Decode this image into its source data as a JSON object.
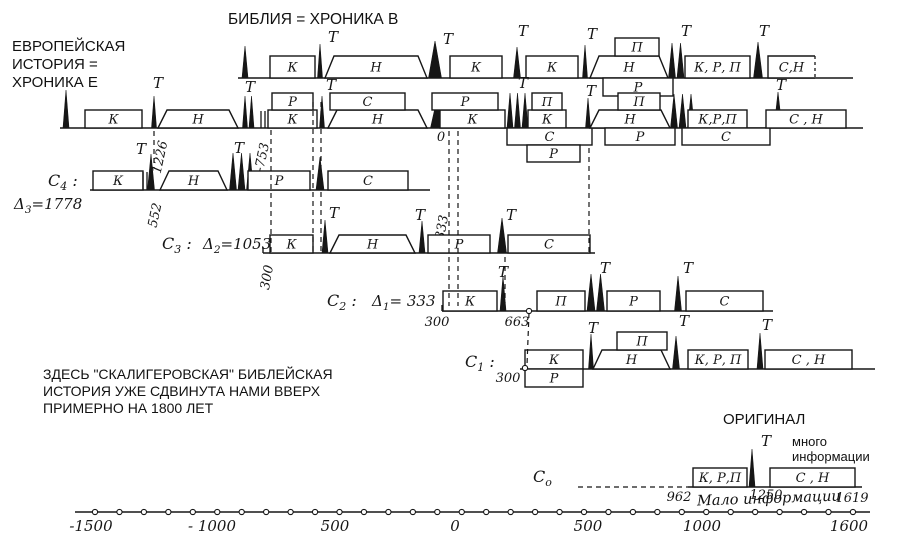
{
  "ink": "#161616",
  "bg": "#ffffff",
  "titles": {
    "bible": "БИБЛИЯ = ХРОНИКА В",
    "europe_lines": [
      "ЕВРОПЕЙСКАЯ",
      "ИСТОРИЯ =",
      "ХРОНИКА Е"
    ],
    "note_lines": [
      "ЗДЕСЬ \"СКАЛИГЕРОВСКАЯ\" БИБЛЕЙСКАЯ",
      "ИСТОРИЯ УЖЕ СДВИНУТА НАМИ ВВЕРХ",
      "ПРИМЕРНО НА 1800 ЛЕТ"
    ],
    "original": "ОРИГИНАЛ",
    "much_info_lines": [
      "много",
      "информации"
    ],
    "little_info": "Мало информации"
  },
  "rows": [
    {
      "id": "B",
      "baseline": {
        "x1": 238,
        "x2": 853,
        "y": 78
      },
      "bh": 22,
      "sh": 18,
      "els": [
        {
          "t": "s",
          "x": 245,
          "h": 32,
          "w": 6
        },
        {
          "t": "b",
          "x": 270,
          "w": 45,
          "l": "К"
        },
        {
          "t": "s",
          "x": 320,
          "h": 34,
          "w": 5
        },
        {
          "t": "T",
          "x": 333,
          "y": 42
        },
        {
          "t": "tr",
          "x": 325,
          "w": 102,
          "l": "Н"
        },
        {
          "t": "s",
          "x": 435,
          "h": 37,
          "w": 13
        },
        {
          "t": "T",
          "x": 448,
          "y": 44
        },
        {
          "t": "b",
          "x": 450,
          "w": 52,
          "l": "К"
        },
        {
          "t": "s",
          "x": 517,
          "h": 31,
          "w": 7
        },
        {
          "t": "T",
          "x": 523,
          "y": 36
        },
        {
          "t": "b",
          "x": 526,
          "w": 52,
          "l": "К"
        },
        {
          "t": "s",
          "x": 585,
          "h": 33,
          "w": 5
        },
        {
          "t": "T",
          "x": 592,
          "y": 39
        },
        {
          "t": "tr",
          "x": 590,
          "w": 78,
          "l": "Н"
        },
        {
          "t": "b",
          "x": 615,
          "w": 44,
          "l": "П",
          "lane": -1
        },
        {
          "t": "b",
          "x": 603,
          "w": 70,
          "l": "Р",
          "lane": 1
        },
        {
          "t": "s",
          "x": 672,
          "h": 35,
          "w": 7,
          "n": 2
        },
        {
          "t": "T",
          "x": 686,
          "y": 36
        },
        {
          "t": "b",
          "x": 685,
          "w": 65,
          "l": "К, Р, П"
        },
        {
          "t": "s",
          "x": 758,
          "h": 36,
          "w": 9
        },
        {
          "t": "T",
          "x": 764,
          "y": 36
        },
        {
          "t": "b",
          "x": 768,
          "w": 47,
          "l": "С,Н",
          "dr": true
        }
      ]
    },
    {
      "id": "E",
      "baseline": {
        "x1": 60,
        "x2": 863,
        "y": 128
      },
      "bh": 18,
      "sh": 17,
      "els": [
        {
          "t": "s",
          "x": 66,
          "h": 38,
          "w": 6
        },
        {
          "t": "b",
          "x": 85,
          "w": 57,
          "l": "К"
        },
        {
          "t": "T",
          "x": 158,
          "y": 88
        },
        {
          "t": "s",
          "x": 154,
          "h": 32,
          "w": 5
        },
        {
          "t": "tr",
          "x": 158,
          "w": 80,
          "l": "Н"
        },
        {
          "t": "s",
          "x": 245,
          "h": 32,
          "w": 5,
          "n": 2
        },
        {
          "t": "T",
          "x": 250,
          "y": 92
        },
        {
          "t": "d",
          "x": 261
        },
        {
          "t": "b",
          "x": 268,
          "w": 49,
          "l": "К"
        },
        {
          "t": "b",
          "x": 272,
          "w": 41,
          "l": "Р",
          "lane": -1
        },
        {
          "t": "s",
          "x": 322,
          "h": 32,
          "w": 5
        },
        {
          "t": "T",
          "x": 331,
          "y": 90
        },
        {
          "t": "tr",
          "x": 328,
          "w": 99,
          "l": "Н"
        },
        {
          "t": "b",
          "x": 330,
          "w": 75,
          "l": "С",
          "lane": -1
        },
        {
          "t": "s",
          "x": 437,
          "h": 29,
          "w": 13
        },
        {
          "t": "b",
          "x": 440,
          "w": 65,
          "l": "К"
        },
        {
          "t": "b",
          "x": 432,
          "w": 66,
          "l": "Р",
          "lane": -1
        },
        {
          "t": "s",
          "x": 510,
          "h": 35,
          "w": 6,
          "n": 3
        },
        {
          "t": "T",
          "x": 523,
          "y": 88
        },
        {
          "t": "b",
          "x": 528,
          "w": 38,
          "l": "К"
        },
        {
          "t": "b",
          "x": 532,
          "w": 30,
          "l": "П",
          "lane": -1
        },
        {
          "t": "b",
          "x": 507,
          "w": 85,
          "l": "С",
          "lane": 1
        },
        {
          "t": "b",
          "x": 527,
          "w": 53,
          "l": "Р",
          "lane": 2
        },
        {
          "t": "s",
          "x": 588,
          "h": 30,
          "w": 5
        },
        {
          "t": "T",
          "x": 591,
          "y": 96
        },
        {
          "t": "tr",
          "x": 590,
          "w": 80,
          "l": "Н"
        },
        {
          "t": "b",
          "x": 618,
          "w": 42,
          "l": "П",
          "lane": -1
        },
        {
          "t": "b",
          "x": 605,
          "w": 70,
          "l": "Р",
          "lane": 1
        },
        {
          "t": "s",
          "x": 674,
          "h": 34,
          "w": 7,
          "n": 3
        },
        {
          "t": "b",
          "x": 688,
          "w": 59,
          "l": "К,Р,П"
        },
        {
          "t": "b",
          "x": 682,
          "w": 88,
          "l": "С",
          "lane": 1
        },
        {
          "t": "s",
          "x": 778,
          "h": 36,
          "w": 8
        },
        {
          "t": "T",
          "x": 781,
          "y": 90
        },
        {
          "t": "b",
          "x": 766,
          "w": 80,
          "l": "С , Н"
        }
      ]
    },
    {
      "id": "C4",
      "baseline": {
        "x1": 90,
        "x2": 430,
        "y": 190
      },
      "bh": 19,
      "sh": 17,
      "label": {
        "main": "С",
        "sub": "4",
        "suffix": " :",
        "x": 48,
        "y": 186
      },
      "delta": {
        "main": "Δ",
        "sub": "3",
        "val": "=1778",
        "x": 14,
        "y": 209
      },
      "els": [
        {
          "t": "b",
          "x": 93,
          "w": 50,
          "l": "К"
        },
        {
          "t": "d",
          "x": 143
        },
        {
          "t": "s",
          "x": 151,
          "h": 36,
          "w": 7
        },
        {
          "t": "T",
          "x": 141,
          "y": 154
        },
        {
          "t": "n",
          "x": 164,
          "y": 158,
          "v": "1226",
          "r": -78
        },
        {
          "t": "n",
          "x": 159,
          "y": 216,
          "v": "552",
          "r": -78
        },
        {
          "t": "tr",
          "x": 160,
          "w": 67,
          "l": "Н"
        },
        {
          "t": "s",
          "x": 233,
          "h": 37,
          "w": 7,
          "n": 3
        },
        {
          "t": "T",
          "x": 239,
          "y": 153
        },
        {
          "t": "b",
          "x": 248,
          "w": 62,
          "l": "Р"
        },
        {
          "t": "s",
          "x": 320,
          "h": 33,
          "w": 8
        },
        {
          "t": "b",
          "x": 328,
          "w": 80,
          "l": "С"
        }
      ]
    },
    {
      "id": "C3",
      "baseline": {
        "x1": 263,
        "x2": 595,
        "y": 253
      },
      "bh": 18,
      "sh": 17,
      "label": {
        "main": "С",
        "sub": "3",
        "suffix": " :",
        "x": 162,
        "y": 249
      },
      "delta": {
        "main": "Δ",
        "sub": "2",
        "val": "=1053",
        "x": 203,
        "y": 249
      },
      "els": [
        {
          "t": "tk",
          "x": 263
        },
        {
          "t": "n",
          "x": 271,
          "y": 278,
          "v": "300",
          "r": -80
        },
        {
          "t": "b",
          "x": 270,
          "w": 43,
          "l": "К"
        },
        {
          "t": "s",
          "x": 325,
          "h": 33,
          "w": 6
        },
        {
          "t": "T",
          "x": 334,
          "y": 218
        },
        {
          "t": "tr",
          "x": 330,
          "w": 85,
          "l": "Н"
        },
        {
          "t": "s",
          "x": 422,
          "h": 32,
          "w": 6
        },
        {
          "t": "T",
          "x": 420,
          "y": 220
        },
        {
          "t": "n",
          "x": 446,
          "y": 228,
          "v": "333",
          "r": -80
        },
        {
          "t": "b",
          "x": 428,
          "w": 62,
          "l": "Р"
        },
        {
          "t": "s",
          "x": 502,
          "h": 35,
          "w": 9
        },
        {
          "t": "T",
          "x": 511,
          "y": 220
        },
        {
          "t": "b",
          "x": 508,
          "w": 82,
          "l": "С"
        }
      ]
    },
    {
      "id": "C2",
      "baseline": {
        "x1": 442,
        "x2": 773,
        "y": 311
      },
      "bh": 20,
      "sh": 17,
      "label": {
        "main": "С",
        "sub": "2",
        "suffix": " :",
        "x": 327,
        "y": 306
      },
      "delta": {
        "main": "Δ",
        "sub": "1",
        "val": "= 333",
        "x": 372,
        "y": 306
      },
      "els": [
        {
          "t": "tk",
          "x": 442
        },
        {
          "t": "n",
          "x": 437,
          "y": 326,
          "v": "300"
        },
        {
          "t": "b",
          "x": 443,
          "w": 54,
          "l": "К"
        },
        {
          "t": "s",
          "x": 503,
          "h": 35,
          "w": 6
        },
        {
          "t": "T",
          "x": 503,
          "y": 277
        },
        {
          "t": "n",
          "x": 517,
          "y": 326,
          "v": "663"
        },
        {
          "t": "b",
          "x": 537,
          "w": 48,
          "l": "П"
        },
        {
          "t": "s",
          "x": 591,
          "h": 37,
          "w": 8,
          "n": 2
        },
        {
          "t": "T",
          "x": 605,
          "y": 273
        },
        {
          "t": "b",
          "x": 607,
          "w": 53,
          "l": "Р"
        },
        {
          "t": "s",
          "x": 678,
          "h": 35,
          "w": 7
        },
        {
          "t": "T",
          "x": 688,
          "y": 273
        },
        {
          "t": "b",
          "x": 686,
          "w": 77,
          "l": "С"
        }
      ]
    },
    {
      "id": "C1",
      "baseline": {
        "x1": 520,
        "x2": 875,
        "y": 369
      },
      "bh": 19,
      "sh": 18,
      "label": {
        "main": "С",
        "sub": "1",
        "suffix": " :",
        "x": 465,
        "y": 367
      },
      "els": [
        {
          "t": "n",
          "x": 508,
          "y": 382,
          "v": "300"
        },
        {
          "t": "b",
          "x": 525,
          "w": 58,
          "l": "К"
        },
        {
          "t": "b",
          "x": 525,
          "w": 58,
          "l": "Р",
          "lane": 1
        },
        {
          "t": "s",
          "x": 591,
          "h": 35,
          "w": 5
        },
        {
          "t": "T",
          "x": 593,
          "y": 333
        },
        {
          "t": "tr",
          "x": 593,
          "w": 77,
          "l": "Н"
        },
        {
          "t": "b",
          "x": 617,
          "w": 50,
          "l": "П",
          "lane": -1
        },
        {
          "t": "s",
          "x": 676,
          "h": 33,
          "w": 7
        },
        {
          "t": "T",
          "x": 684,
          "y": 326
        },
        {
          "t": "b",
          "x": 688,
          "w": 60,
          "l": "К, Р, П"
        },
        {
          "t": "s",
          "x": 760,
          "h": 36,
          "w": 6
        },
        {
          "t": "T",
          "x": 767,
          "y": 330
        },
        {
          "t": "b",
          "x": 765,
          "w": 87,
          "l": "С , Н"
        }
      ]
    },
    {
      "id": "C0",
      "baseline": {
        "x1": 688,
        "x2": 862,
        "y": 487
      },
      "bh": 19,
      "sh": 17,
      "label": {
        "main": "С",
        "sub": "о",
        "suffix": "",
        "x": 533,
        "y": 482
      },
      "els": [
        {
          "t": "n",
          "x": 679,
          "y": 501,
          "v": "962"
        },
        {
          "t": "b",
          "x": 693,
          "w": 54,
          "l": "К, Р,П"
        },
        {
          "t": "s",
          "x": 752,
          "h": 38,
          "w": 6
        },
        {
          "t": "T",
          "x": 766,
          "y": 446
        },
        {
          "t": "n",
          "x": 766,
          "y": 499,
          "v": "1250"
        },
        {
          "t": "b",
          "x": 770,
          "w": 85,
          "l": "С , Н"
        },
        {
          "t": "n",
          "x": 852,
          "y": 502,
          "v": "1619"
        }
      ]
    }
  ],
  "free_nums": [
    {
      "x": 266,
      "y": 158,
      "v": "-753",
      "r": -78
    },
    {
      "x": 441,
      "y": 141,
      "v": "0"
    }
  ],
  "dashes": [
    {
      "x1": 154,
      "y1": 131,
      "x2": 154,
      "y2": 168
    },
    {
      "x1": 271,
      "y1": 130,
      "x2": 271,
      "y2": 252
    },
    {
      "x1": 313,
      "y1": 102,
      "x2": 313,
      "y2": 252
    },
    {
      "x1": 321,
      "y1": 102,
      "x2": 321,
      "y2": 252
    },
    {
      "x1": 449,
      "y1": 131,
      "x2": 449,
      "y2": 306
    },
    {
      "x1": 458,
      "y1": 131,
      "x2": 458,
      "y2": 306
    },
    {
      "x1": 505,
      "y1": 257,
      "x2": 505,
      "y2": 303
    },
    {
      "x1": 529,
      "y1": 313,
      "x2": 527,
      "y2": 365
    },
    {
      "x1": 589,
      "y1": 148,
      "x2": 589,
      "y2": 252
    },
    {
      "x1": 578,
      "y1": 487,
      "x2": 688,
      "y2": 487
    }
  ],
  "circles": [
    {
      "x": 529,
      "y": 311
    },
    {
      "x": 525,
      "y": 368
    }
  ],
  "axis": {
    "y": 512,
    "x1": 75,
    "x2": 870,
    "circle_start": 95,
    "circle_step": 24.45,
    "circle_count": 32,
    "tick_y": 531,
    "ticks": [
      {
        "x": 91,
        "v": "-1500"
      },
      {
        "x": 212,
        "v": "- 1000"
      },
      {
        "x": 335,
        "v": "500"
      },
      {
        "x": 455,
        "v": "0"
      },
      {
        "x": 588,
        "v": "500"
      },
      {
        "x": 702,
        "v": "1000"
      },
      {
        "x": 849,
        "v": "1600"
      }
    ]
  }
}
